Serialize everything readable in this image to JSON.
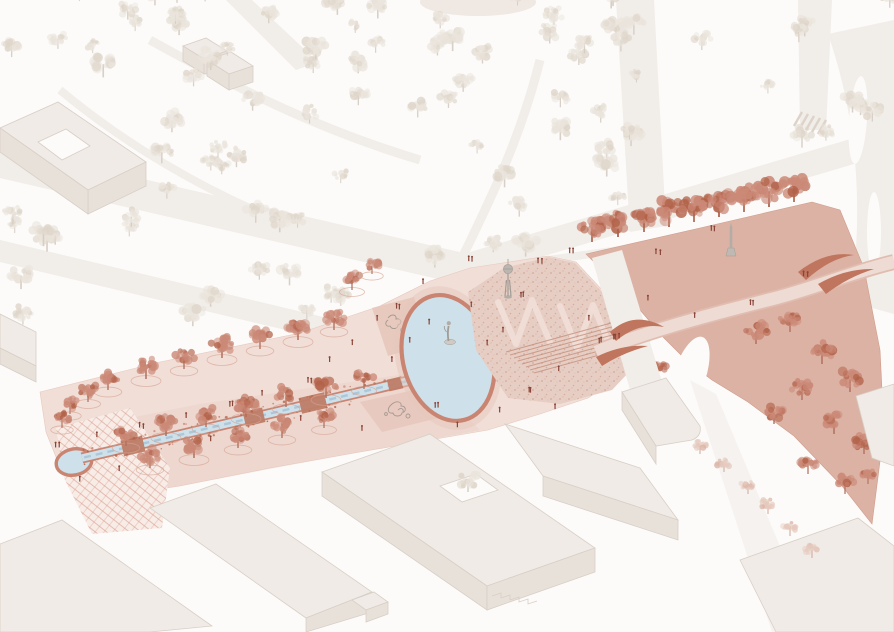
{
  "illustration": {
    "type": "axonometric-masterplan",
    "aria_label": "Axonometric masterplan illustration of a pink linear park with canal, circular pool, oval pond with statue, stippled sculpture garden with tower, triangular paved wedge plaza with monument and tree row, S-curved pedestrian ribbon bridge, surrounding streets, faint tree park and light grey buildings"
  },
  "palette": {
    "background": "#fcfbf9",
    "road": "#f1ede8",
    "faint_tree": "#eae4dc",
    "faint_tree_speck": "#ded5c9",
    "faint_trunk": "#d5ccc1",
    "building_top": "#f0ebe6",
    "building_side": "#e8e1da",
    "building_edge": "#d8cfc6",
    "park_pink": "#f1ded7",
    "park_pink_dark": "#e6c8bc",
    "playground": "#e6c6ba",
    "playground_sketch": "#8f8983",
    "hatch_base": "#f8ece7",
    "hatch_line": "#d69484",
    "stipple_base": "#e7cec4",
    "stipple_dot": "#c08a77",
    "wedge": "#dcb2a4",
    "wedge_edge": "#cf9c8b",
    "pink_tree": "#cb8977",
    "pink_tree_speck": "#b26249",
    "pink_trunk": "#b1705d",
    "faint_pink_tree": "#e6cabe",
    "faint_pink_speck": "#d9b2a3",
    "faint_pink_trunk": "#cfa291",
    "tree_pit": "#d6a291",
    "water": "#cee0ea",
    "water_edge": "#c98571",
    "water_sketch": "#a5c2d4",
    "canal_bridge": "#bf7e68",
    "bridge_fill": "#eedbd3",
    "bridge_dark": "#bf755e",
    "monument": "#b3ada7",
    "monument_dark": "#a29c96",
    "people": "#8a4437",
    "steps_line": "#c58f7c",
    "crosswalk": "#ddd3c9"
  },
  "icons": {
    "pond_statue": "standing-figure-statue",
    "garden_tower": "lookout-tower-sculpture",
    "wedge_monument": "obelisk-monument"
  },
  "trees": {
    "layers": [
      {
        "group": "upper-park-trees",
        "mode": "scatter",
        "region": [
          0,
          0,
          640,
          335
        ],
        "count": 82,
        "smin": 7,
        "smax": 13,
        "colors": {
          "foliage": "faint_tree",
          "speck": "faint_tree_speck",
          "trunk": "faint_trunk"
        },
        "pit": false,
        "opacity": 0.9,
        "exclude": true
      },
      {
        "group": "upper-park-trees",
        "mode": "scatter",
        "region": [
          560,
          0,
          330,
          150
        ],
        "count": 13,
        "smin": 7,
        "smax": 12,
        "colors": {
          "foliage": "faint_tree",
          "speck": "faint_tree_speck",
          "trunk": "faint_trunk"
        },
        "pit": false,
        "opacity": 0.9,
        "exclude": false
      },
      {
        "group": "canal-trees",
        "mode": "list",
        "colors": {
          "foliage": "pink_tree",
          "speck": "pink_tree_speck",
          "trunk": "pink_trunk"
        },
        "pit": true,
        "opacity": 0.95,
        "positions": [
          [
            108,
            390,
            11
          ],
          [
            146,
            379,
            12
          ],
          [
            184,
            369,
            11
          ],
          [
            222,
            358,
            12
          ],
          [
            260,
            349,
            11
          ],
          [
            298,
            340,
            12
          ],
          [
            334,
            330,
            11
          ],
          [
            70,
            414,
            9
          ],
          [
            88,
            402,
            10
          ],
          [
            62,
            428,
            9
          ],
          [
            126,
            446,
            11
          ],
          [
            166,
            436,
            12
          ],
          [
            206,
            427,
            11
          ],
          [
            246,
            417,
            12
          ],
          [
            286,
            407,
            11
          ],
          [
            326,
            398,
            12
          ],
          [
            364,
            389,
            10
          ],
          [
            150,
            468,
            11
          ],
          [
            194,
            458,
            12
          ],
          [
            238,
            448,
            11
          ],
          [
            282,
            438,
            11
          ],
          [
            324,
            428,
            10
          ],
          [
            352,
            290,
            10
          ],
          [
            372,
            274,
            9
          ]
        ]
      },
      {
        "group": "wedge-trees",
        "mode": "list",
        "colors": {
          "foliage": "pink_tree",
          "speck": "pink_tree_speck",
          "trunk": "pink_trunk"
        },
        "pit": false,
        "opacity": 1,
        "positions": [
          [
            592,
            242,
            14
          ],
          [
            618,
            237,
            15
          ],
          [
            644,
            232,
            14
          ],
          [
            669,
            227,
            15
          ],
          [
            694,
            222,
            14
          ],
          [
            719,
            217,
            15
          ],
          [
            744,
            212,
            14
          ],
          [
            769,
            207,
            15
          ],
          [
            794,
            202,
            14
          ]
        ]
      },
      {
        "group": "wedge-trees",
        "mode": "list",
        "colors": {
          "foliage": "pink_tree",
          "speck": "pink_tree_speck",
          "trunk": "pink_trunk"
        },
        "pit": false,
        "opacity": 0.95,
        "positions": [
          [
            640,
            364,
            10
          ],
          [
            658,
            377,
            9
          ],
          [
            756,
            344,
            12
          ],
          [
            790,
            332,
            11
          ],
          [
            822,
            364,
            12
          ],
          [
            850,
            392,
            12
          ],
          [
            802,
            400,
            11
          ],
          [
            774,
            424,
            11
          ],
          [
            834,
            434,
            12
          ],
          [
            864,
            454,
            11
          ],
          [
            808,
            474,
            10
          ],
          [
            845,
            494,
            10
          ],
          [
            868,
            484,
            9
          ]
        ]
      },
      {
        "group": "roadside-trees",
        "mode": "list",
        "colors": {
          "foliage": "faint_pink_tree",
          "speck": "faint_pink_speck",
          "trunk": "faint_pink_trunk"
        },
        "pit": false,
        "opacity": 0.9,
        "positions": [
          [
            700,
            454,
            8
          ],
          [
            724,
            472,
            8
          ],
          [
            748,
            494,
            8
          ],
          [
            768,
            514,
            8
          ],
          [
            790,
            536,
            8
          ],
          [
            812,
            558,
            8
          ]
        ]
      },
      {
        "group": "courtyard-tree",
        "mode": "list",
        "colors": {
          "foliage": "faint_tree",
          "speck": "faint_tree_speck",
          "trunk": "faint_trunk"
        },
        "pit": false,
        "opacity": 1,
        "positions": [
          [
            468,
            492,
            11
          ]
        ]
      }
    ]
  },
  "people": {
    "clusters": [
      [
        58,
        447,
        2
      ],
      [
        96,
        437,
        1
      ],
      [
        142,
        428,
        2
      ],
      [
        186,
        417,
        1
      ],
      [
        232,
        406,
        2
      ],
      [
        262,
        395,
        1
      ],
      [
        300,
        421,
        1
      ],
      [
        310,
        383,
        2
      ],
      [
        352,
        345,
        1
      ],
      [
        362,
        431,
        1
      ],
      [
        398,
        309,
        2
      ],
      [
        410,
        343,
        1
      ],
      [
        392,
        362,
        1
      ],
      [
        430,
        324,
        1
      ],
      [
        437,
        407,
        2
      ],
      [
        458,
        428,
        1
      ],
      [
        472,
        307,
        1
      ],
      [
        488,
        345,
        1
      ],
      [
        502,
        333,
        1
      ],
      [
        522,
        297,
        2
      ],
      [
        540,
        263,
        2
      ],
      [
        572,
        253,
        2
      ],
      [
        588,
        321,
        1
      ],
      [
        600,
        343,
        2
      ],
      [
        616,
        339,
        3
      ],
      [
        648,
        301,
        1
      ],
      [
        658,
        255,
        2
      ],
      [
        694,
        318,
        1
      ],
      [
        712,
        231,
        2
      ],
      [
        752,
        306,
        2
      ],
      [
        806,
        277,
        2
      ],
      [
        530,
        393,
        2
      ],
      [
        556,
        409,
        1
      ],
      [
        470,
        261,
        2
      ],
      [
        424,
        283,
        1
      ],
      [
        378,
        321,
        1
      ],
      [
        330,
        361,
        1
      ],
      [
        210,
        441,
        1
      ],
      [
        120,
        471,
        1
      ],
      [
        80,
        481,
        1
      ],
      [
        500,
        412,
        1
      ],
      [
        558,
        372,
        1
      ]
    ]
  },
  "canal_specks": {
    "count": 80,
    "from": [
      82,
      458
    ],
    "to": [
      412,
      380
    ]
  }
}
